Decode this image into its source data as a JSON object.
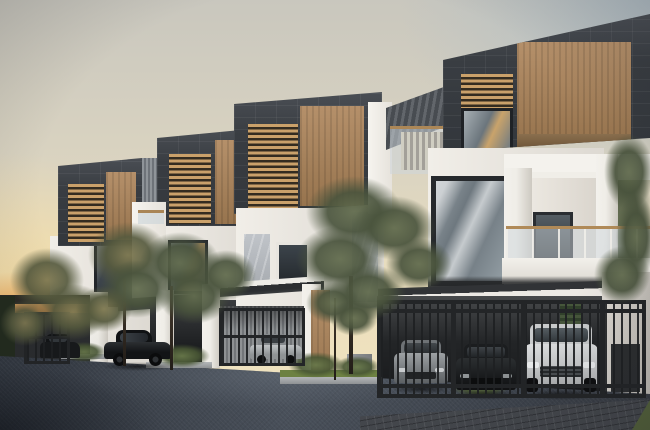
{
  "scene": {
    "description": "Dusk 3D architectural rendering of a row of four modern three-storey townhouses with charcoal stone roof boxes, timber cladding and louvers, white walls, glass balconies, gated carports with parked cars, slender trees and a dark paved driveway in the foreground",
    "time_of_day": "dusk",
    "image_type": "3d-architectural-render",
    "text_visible": "none"
  },
  "palette": {
    "sky_warm": "#f1e4c1",
    "sky_cool": "#c3ccd3",
    "sunset_glow": "#dd9a55",
    "charcoal_cladding": "#3a3e43",
    "timber_panel": "#a8845c",
    "white_wall": "#f1eee8",
    "marble_panel": "#b7bbc0",
    "window_glass": "#8d979e",
    "gate_metal": "#26282a",
    "foliage": "#5d684e",
    "pavement": "#424851",
    "grass": "#6d8142"
  },
  "buildings": {
    "count": 4,
    "units": [
      {
        "id": "unit-1",
        "label": "Townhouse unit 1, far left",
        "features": [
          "charcoal roof box",
          "timber louver window",
          "timber feature panel",
          "gated carport"
        ]
      },
      {
        "id": "unit-2",
        "label": "Townhouse unit 2",
        "features": [
          "charcoal roof box",
          "timber louver window",
          "timber feature panel",
          "open carport"
        ]
      },
      {
        "id": "unit-3",
        "label": "Townhouse unit 3",
        "features": [
          "charcoal roof box",
          "timber louver window",
          "marble wall panels",
          "timber entry door",
          "gated carport"
        ]
      },
      {
        "id": "unit-4",
        "label": "Townhouse unit 4, foreground",
        "features": [
          "charcoal roof box",
          "timber feature panel",
          "roof terrace with louvered awning",
          "glass balcony with timber handrail",
          "triple-bay gated carport",
          "vertical garden strip"
        ]
      }
    ]
  },
  "vehicles": [
    {
      "id": "car-1",
      "color": "dark grey",
      "type": "sedan",
      "location": "behind unit 1 gate"
    },
    {
      "id": "car-2",
      "color": "black",
      "type": "sedan",
      "location": "unit 2 open carport"
    },
    {
      "id": "car-3",
      "color": "silver",
      "type": "sedan",
      "location": "behind unit 3 gate"
    },
    {
      "id": "car-4",
      "color": "grey",
      "type": "sedan",
      "location": "behind unit 4 gate, left bay"
    },
    {
      "id": "car-5",
      "color": "black",
      "type": "sedan",
      "location": "behind unit 4 gate, centre bay"
    },
    {
      "id": "car-6",
      "color": "white",
      "type": "suv",
      "location": "behind unit 4 gate, right bay"
    }
  ],
  "landscape": {
    "trees": "slender olive-green trees between units and along both edges",
    "planters": "raised concrete-edged planters with shrubs and grass strips along the driveway",
    "hedge": "dark hedge and pergola beam at far left with orange sunset glow behind",
    "driveway": "dark blue-grey paved driveway with brick pavers at lower right"
  }
}
